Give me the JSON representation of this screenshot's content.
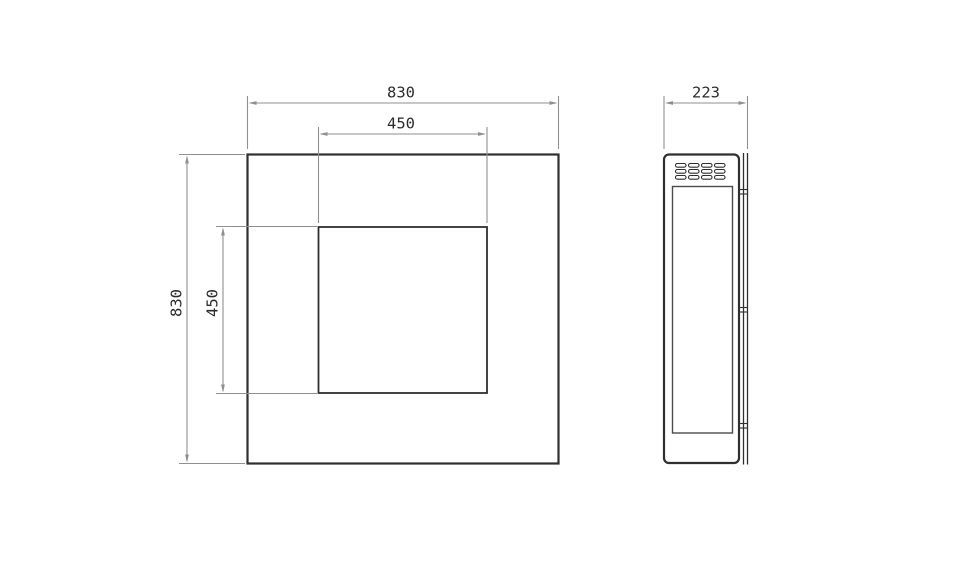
{
  "colors": {
    "object_line": "#2f2f2f",
    "detail_line": "#4b4b4b",
    "dimension_line": "#8f8f8f",
    "label_text": "#2b2b2b",
    "background": "#ffffff"
  },
  "front_view": {
    "overall_width_label": "830",
    "overall_height_label": "830",
    "opening_width_label": "450",
    "opening_height_label": "450"
  },
  "side_view": {
    "depth_label": "223"
  }
}
